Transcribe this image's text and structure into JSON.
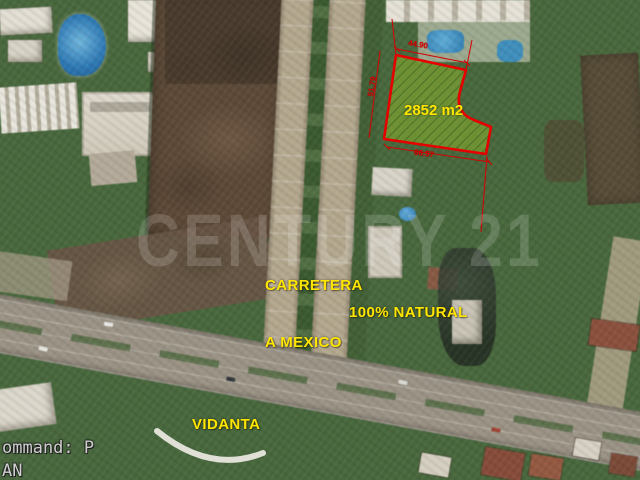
{
  "watermark": {
    "text": "CENTURY 21"
  },
  "labels": {
    "carretera_line1": "CARRETERA",
    "carretera_line2": "A MEXICO",
    "natural": "100% NATURAL",
    "vidanta": "VIDANTA"
  },
  "parcel": {
    "area": "2852 m2",
    "dim_top": "44.90",
    "dim_left": "51.79",
    "dim_bottom": "66.57",
    "outline_color": "#e60000",
    "fill_color": "#86aa2e",
    "area_label_color": "#ffe600",
    "dimension_color": "#d40000"
  },
  "command_bar": {
    "line1": "ommand: P",
    "line2": "AN"
  }
}
